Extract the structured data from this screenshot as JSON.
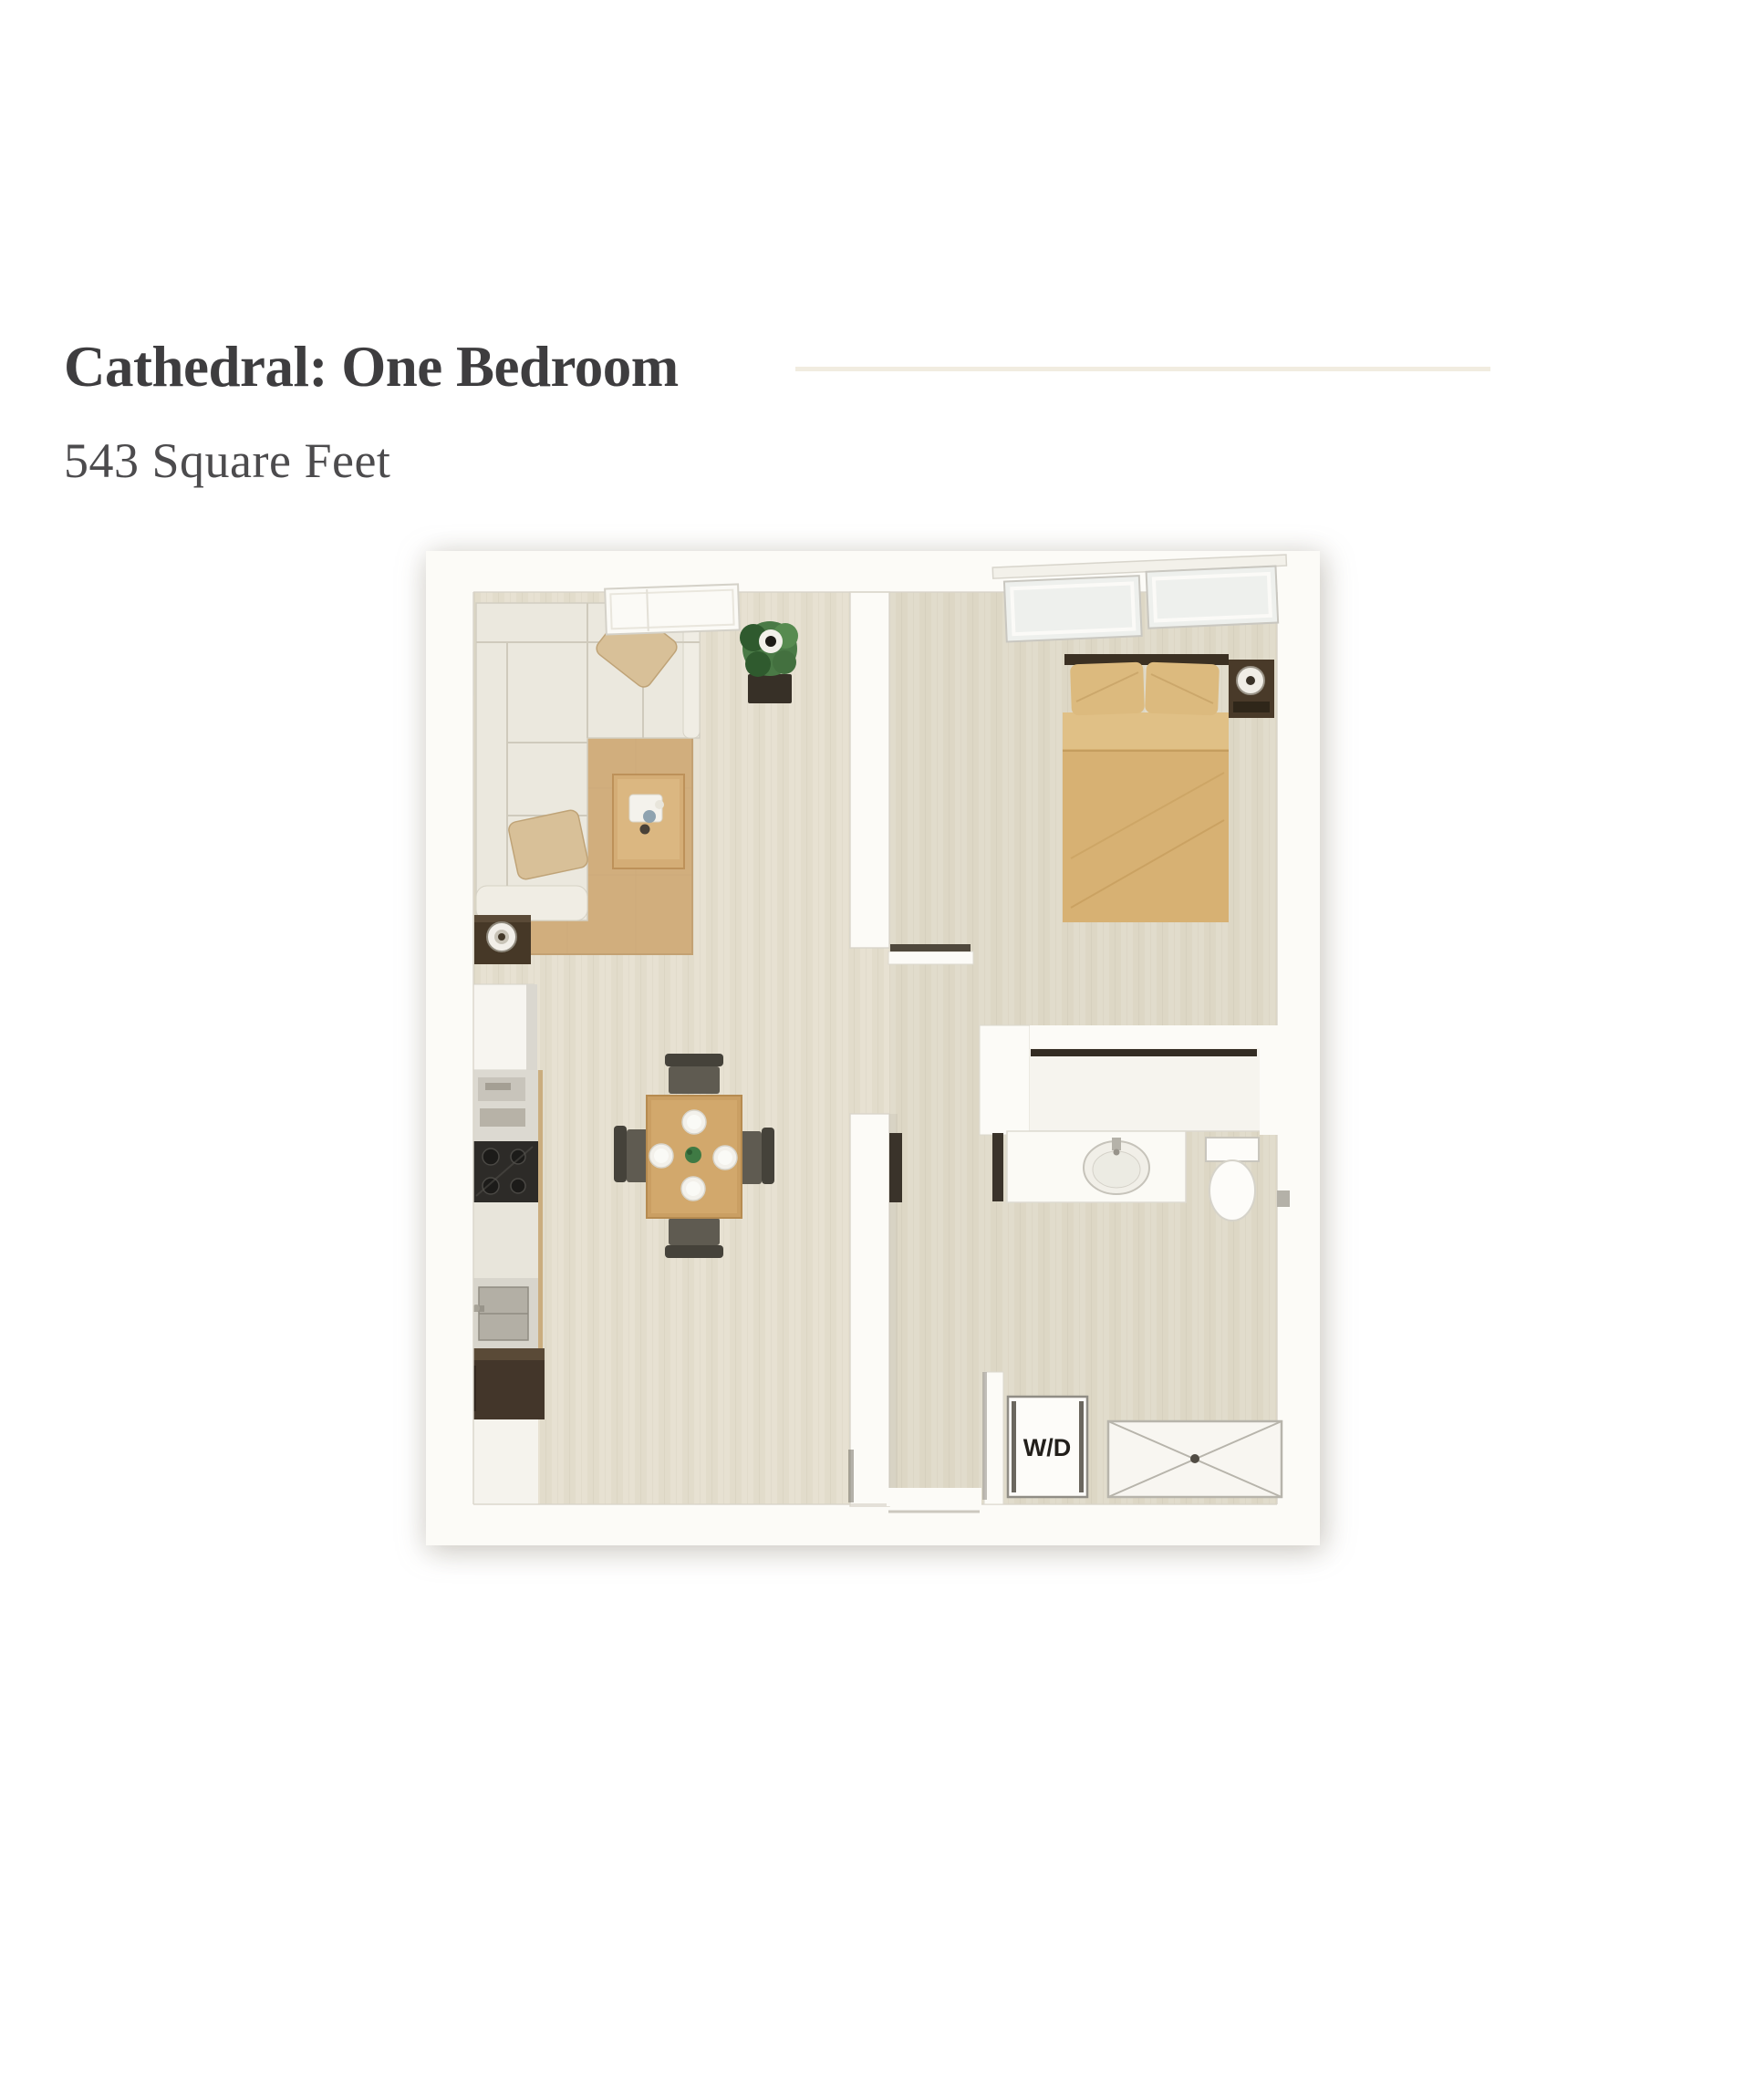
{
  "page": {
    "title": "Cathedral: One Bedroom",
    "subtitle": "543 Square Feet"
  },
  "floorplan": {
    "description": "Top-down 3D rendered floor plan of a one bedroom apartment",
    "labels": {
      "washer_dryer": "W/D"
    },
    "elements": [
      "living-room with L-sectional-sofa, two throw pillows, coffee-table, side-table-lamp, area-rug, potted-plant, window",
      "kitchen run along left wall: cabinet, prep-counter, cooktop, counter, sink, refrigerator, base-cabinet",
      "dining-table with four plates, centerpiece and four chairs",
      "bedroom with double-bed, two pillows, headboard, nightstand-lamp, two angled windows",
      "closet with hanging rod",
      "bathroom with vanity-sink, toilet, door-leaves",
      "laundry closet with stacked washer-dryer",
      "shower pan marked with X",
      "hallway entry at bottom"
    ],
    "colors": {
      "accent_rule": "#f1ece0",
      "title_text": "#3e3d3f",
      "subtitle_text": "#4c4b4d",
      "wall": "#fcfbf7",
      "wall_edge": "#d8d4c9",
      "floor": "#e7e1d2",
      "floor_stripe": "#ddd6c4",
      "rug": "#d1ae7d",
      "rug_edge": "#c3a173",
      "sofa": "#ebe8de",
      "sofa_arm": "#f0ede4",
      "sofa_seam": "#cfcabc",
      "pillow": "#d8c098",
      "pillow_shade": "#bfa377",
      "wood": "#d4ad76",
      "wood_edge": "#bd9159",
      "table_wood": "#ca9f63",
      "bed": "#d7b173",
      "bed_fold": "#e0c086",
      "bed_seam": "#c79f5f",
      "headboard": "#3b3022",
      "dark_furniture": "#463827",
      "appliance_dark": "#2d2b28",
      "steel": "#b3afa5",
      "chair_back": "#45423a",
      "chair_seat": "#5f5b51",
      "fixture": "#fdfcf9",
      "fixture_line": "#b7b4ab",
      "rod": "#332c23",
      "door_dark": "#3a332a",
      "plant_leaf": "#4a7a46",
      "plant_dark": "#2f5a2e",
      "plant_pot": "#373027",
      "plate": "#f3f1eb",
      "centerpiece": "#3f7a44",
      "label_text": "#221f1b"
    }
  }
}
